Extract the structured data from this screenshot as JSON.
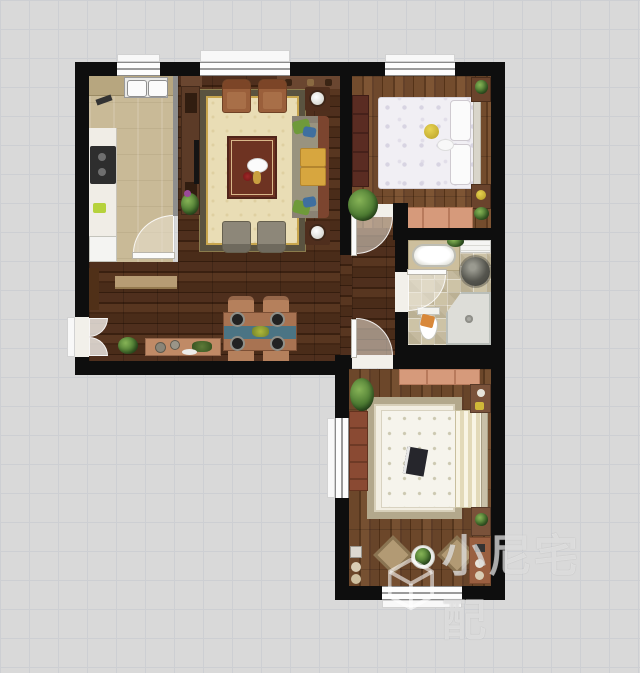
{
  "watermark": {
    "text": "小尼宅配",
    "logo": "cube-logo"
  },
  "palette": {
    "background": "#d9d9d9",
    "grid_line": "#c7cad1",
    "wall": "#0e0e0e",
    "wood_dark_floor": "#45291a",
    "wood_mid_floor": "#6b4629",
    "kitchen_floor": "#c9ba97",
    "bathroom_tile": "#cdc3a6",
    "rug_field": "#e9ddb5",
    "rug_border": "#5a5340",
    "table_runner_teal": "#4b7484",
    "salmon_furniture": "#d69a7b",
    "watermark_white": "rgba(255,255,255,0.58)"
  },
  "rooms": [
    {
      "name": "kitchen",
      "furniture": [
        "double-sink",
        "top-counter",
        "left-counter",
        "stove",
        "fridge",
        "door"
      ]
    },
    {
      "name": "living-room",
      "furniture": [
        "area-rug",
        "coffee-table",
        "sofa",
        "throw-pillows",
        "wood-armchair",
        "wood-armchair",
        "gray-chair",
        "gray-chair",
        "side-table-with-lamp",
        "side-table-with-lamp",
        "tv-console",
        "tv",
        "wall-cabinets",
        "plant"
      ]
    },
    {
      "name": "dining-area",
      "furniture": [
        "dining-table",
        "table-runner",
        "plates",
        "centerpiece",
        "chair",
        "chair",
        "chair",
        "chair",
        "sideboard",
        "bench",
        "floor-plant",
        "wall-cabinet",
        "entrance-double-door"
      ]
    },
    {
      "name": "bedroom-top",
      "furniture": [
        "double-bed",
        "pillows",
        "teddy-bear",
        "wardrobe",
        "nightstand",
        "nightstand",
        "bench",
        "plant",
        "door"
      ]
    },
    {
      "name": "bathroom",
      "furniture": [
        "bathtub",
        "counter",
        "stone-basin",
        "toilet",
        "corner-shower",
        "shelf",
        "plant",
        "door",
        "window"
      ]
    },
    {
      "name": "bedroom-bottom",
      "furniture": [
        "double-bed",
        "area-rug",
        "book",
        "dresser",
        "dresser",
        "nightstand",
        "nightstand",
        "ottoman",
        "ottoman",
        "plant",
        "plant",
        "decor-circles",
        "window"
      ]
    },
    {
      "name": "hallway",
      "furniture": [
        "plant"
      ]
    }
  ]
}
